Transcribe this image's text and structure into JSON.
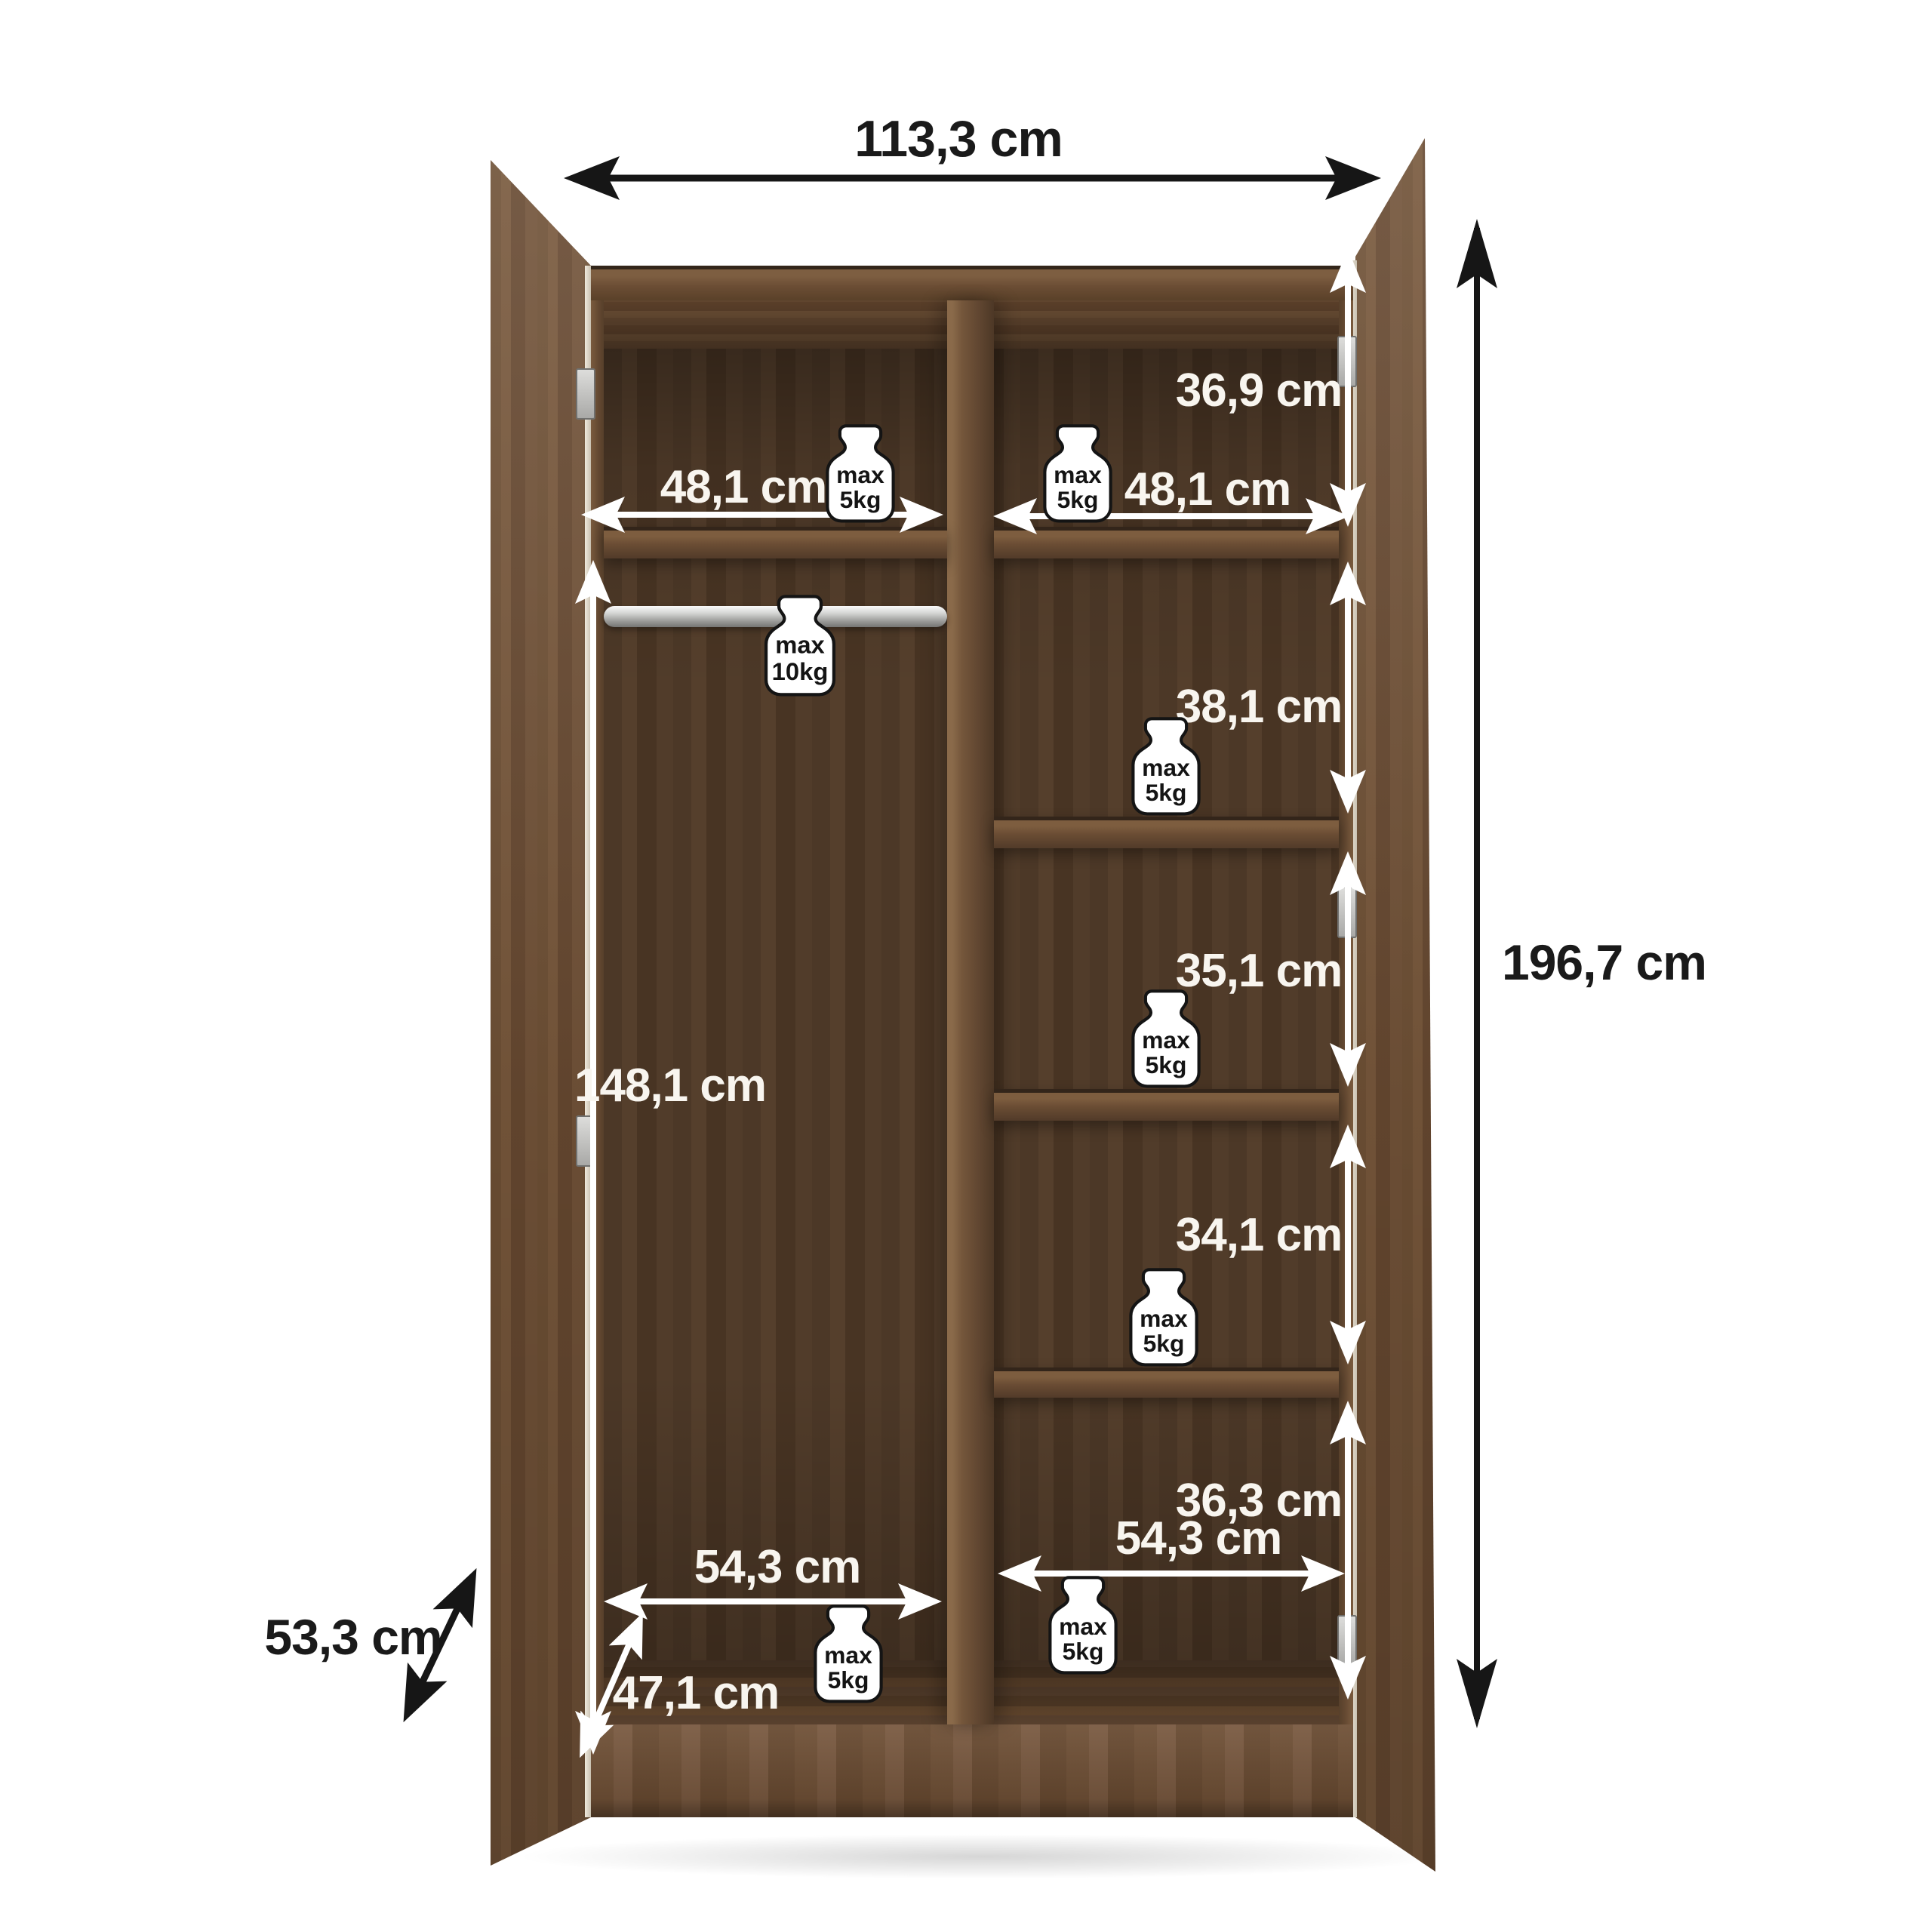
{
  "diagram": {
    "type": "furniture-dimension-diagram",
    "subject": "two-door wardrobe, open, interior dimensions",
    "palette": {
      "wood_mid": "#6f5138",
      "wood_dark": "#4e3a2a",
      "metal": "#c9c9c7",
      "annotation_white": "#ffffff",
      "annotation_black": "#161616"
    },
    "dims": {
      "width": "113,3 cm",
      "height": "196,7 cm",
      "depth": "53,3 cm",
      "shelf_left": "48,1 cm",
      "shelf_right": "48,1 cm",
      "comp1": "36,9 cm",
      "comp2": "38,1 cm",
      "comp3": "35,1 cm",
      "comp4": "34,1 cm",
      "comp5": "36,3 cm",
      "hang": "148,1 cm",
      "bottom_left": "54,3 cm",
      "bottom_right": "54,3 cm",
      "inner_depth": "47,1 cm"
    },
    "badge": {
      "max": "max",
      "kg5": "5kg",
      "kg10": "10kg"
    }
  }
}
